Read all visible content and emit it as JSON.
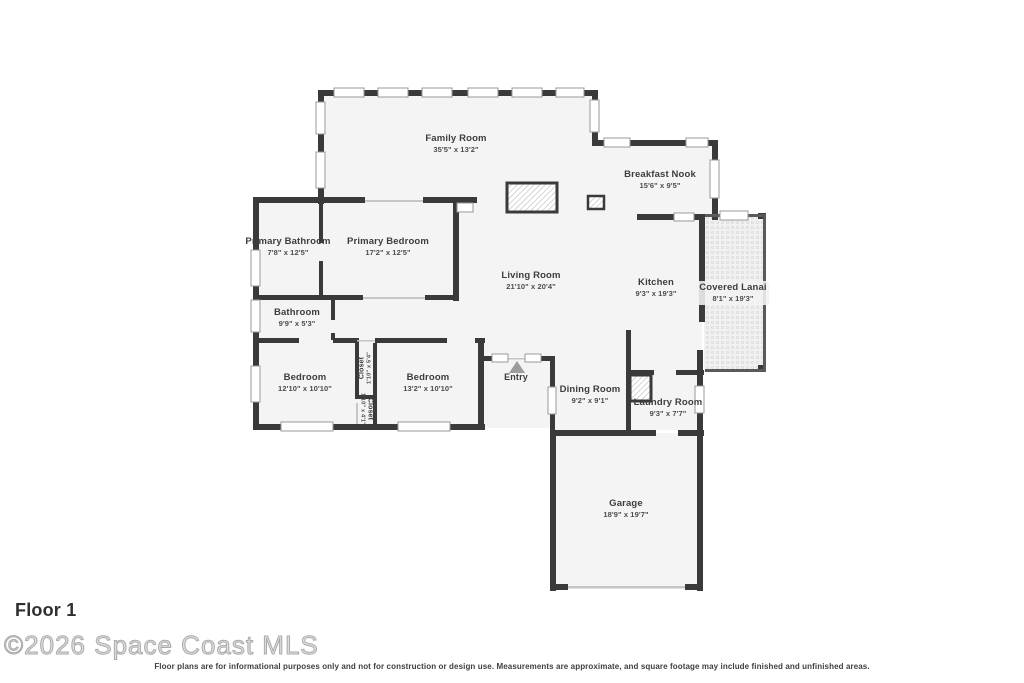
{
  "plan": {
    "floor_label": "Floor 1",
    "watermark": "©2026 Space Coast MLS",
    "disclaimer": "Floor plans are for informational purposes only and not for construction or design use. Measurements are approximate, and square footage may include finished and unfinished areas.",
    "colors": {
      "wall": "#3a3a3a",
      "floor": "#f4f4f4",
      "window_outline": "#9a9a9a",
      "label_text": "#3d3d3d",
      "watermark_gray": "#c9c9c9"
    },
    "icons": [
      "entry-arrow-icon",
      "fireplace-hatch",
      "appliance-hatch",
      "lanai-screen-pattern"
    ]
  },
  "rooms": [
    {
      "id": "family-room",
      "name": "Family Room",
      "dims": "35'5\" x 13'2\""
    },
    {
      "id": "breakfast-nook",
      "name": "Breakfast Nook",
      "dims": "15'6\" x 9'5\""
    },
    {
      "id": "primary-bathroom",
      "name": "Primary Bathroom",
      "dims": "7'8\" x 12'5\""
    },
    {
      "id": "primary-bedroom",
      "name": "Primary Bedroom",
      "dims": "17'2\" x 12'5\""
    },
    {
      "id": "living-room",
      "name": "Living Room",
      "dims": "21'10\" x 20'4\""
    },
    {
      "id": "kitchen",
      "name": "Kitchen",
      "dims": "9'3\" x 19'3\""
    },
    {
      "id": "covered-lanai",
      "name": "Covered Lanai",
      "dims": "8'1\" x 19'3\""
    },
    {
      "id": "bathroom",
      "name": "Bathroom",
      "dims": "9'9\" x 5'3\""
    },
    {
      "id": "bedroom-left",
      "name": "Bedroom",
      "dims": "12'10\" x 10'10\""
    },
    {
      "id": "closet-upper",
      "name": "Closet",
      "dims": "1'10\" x 5'4\""
    },
    {
      "id": "closet-lower",
      "name": "Closet",
      "dims": "1'10\" x 4'1\""
    },
    {
      "id": "bedroom-right",
      "name": "Bedroom",
      "dims": "13'2\" x 10'10\""
    },
    {
      "id": "entry",
      "name": "Entry",
      "dims": ""
    },
    {
      "id": "dining-room",
      "name": "Dining Room",
      "dims": "9'2\" x 9'1\""
    },
    {
      "id": "laundry-room",
      "name": "Laundry Room",
      "dims": "9'3\" x 7'7\""
    },
    {
      "id": "garage",
      "name": "Garage",
      "dims": "18'9\" x 19'7\""
    }
  ]
}
